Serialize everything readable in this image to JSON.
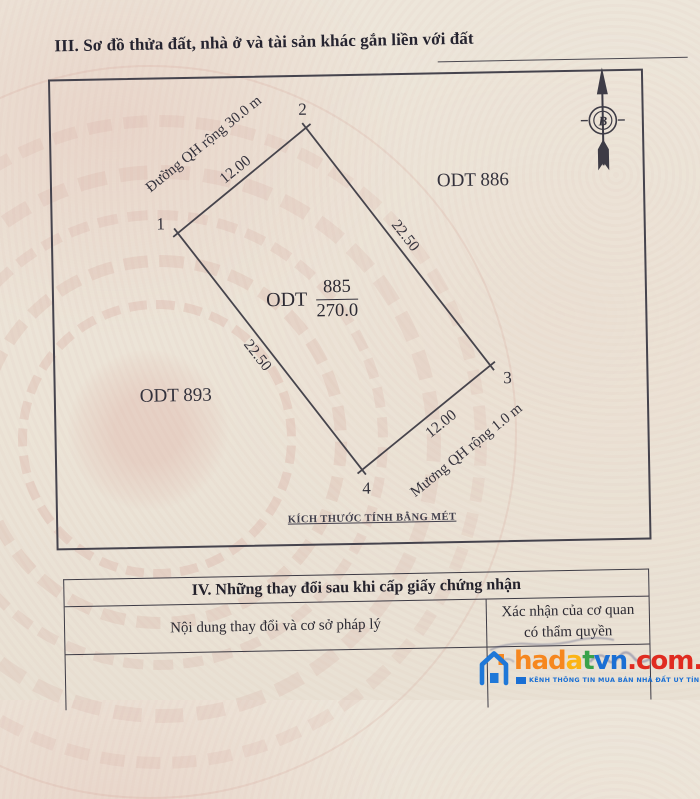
{
  "document": {
    "section3_title": "III. Sơ đồ thửa đất, nhà ở và tài sản khác gắn liền với đất",
    "scale_note": "KÍCH THƯỚC TÍNH BẰNG MÉT"
  },
  "diagram": {
    "compass": {
      "letter": "B"
    },
    "parcel": {
      "prefix": "ODT",
      "number": "885",
      "area": "270.0"
    },
    "neighbors": {
      "right": "ODT 886",
      "left": "ODT 893"
    },
    "roads": {
      "top": "Đường QH rộng 30.0 m",
      "bottom": "Mương QH rộng 1.0 m"
    },
    "vertices": {
      "v1": "1",
      "v2": "2",
      "v3": "3",
      "v4": "4"
    },
    "dimensions": {
      "top": "12.00",
      "right": "22.50",
      "left": "22.50",
      "bottom": "12.00"
    }
  },
  "section4": {
    "title": "IV. Những thay đổi sau khi cấp giấy chứng nhận",
    "col_content": "Nội dung thay đổi và cơ sở pháp lý",
    "col_confirm_line1": "Xác nhận của cơ quan",
    "col_confirm_line2": "có thẩm quyền"
  },
  "watermark": {
    "brand_part1": "had",
    "brand_part2": "a",
    "brand_part3": "t",
    "brand_part4": "vn",
    "brand_domain": ".com.vn",
    "tagline": "KÊNH THÔNG TIN MUA BÁN NHÀ ĐẤT UY TÍN",
    "colors": {
      "orange": "#f6871f",
      "yellow": "#fcb415",
      "green": "#39a24a",
      "blue": "#1a6fd4",
      "red": "#e02b20"
    }
  }
}
